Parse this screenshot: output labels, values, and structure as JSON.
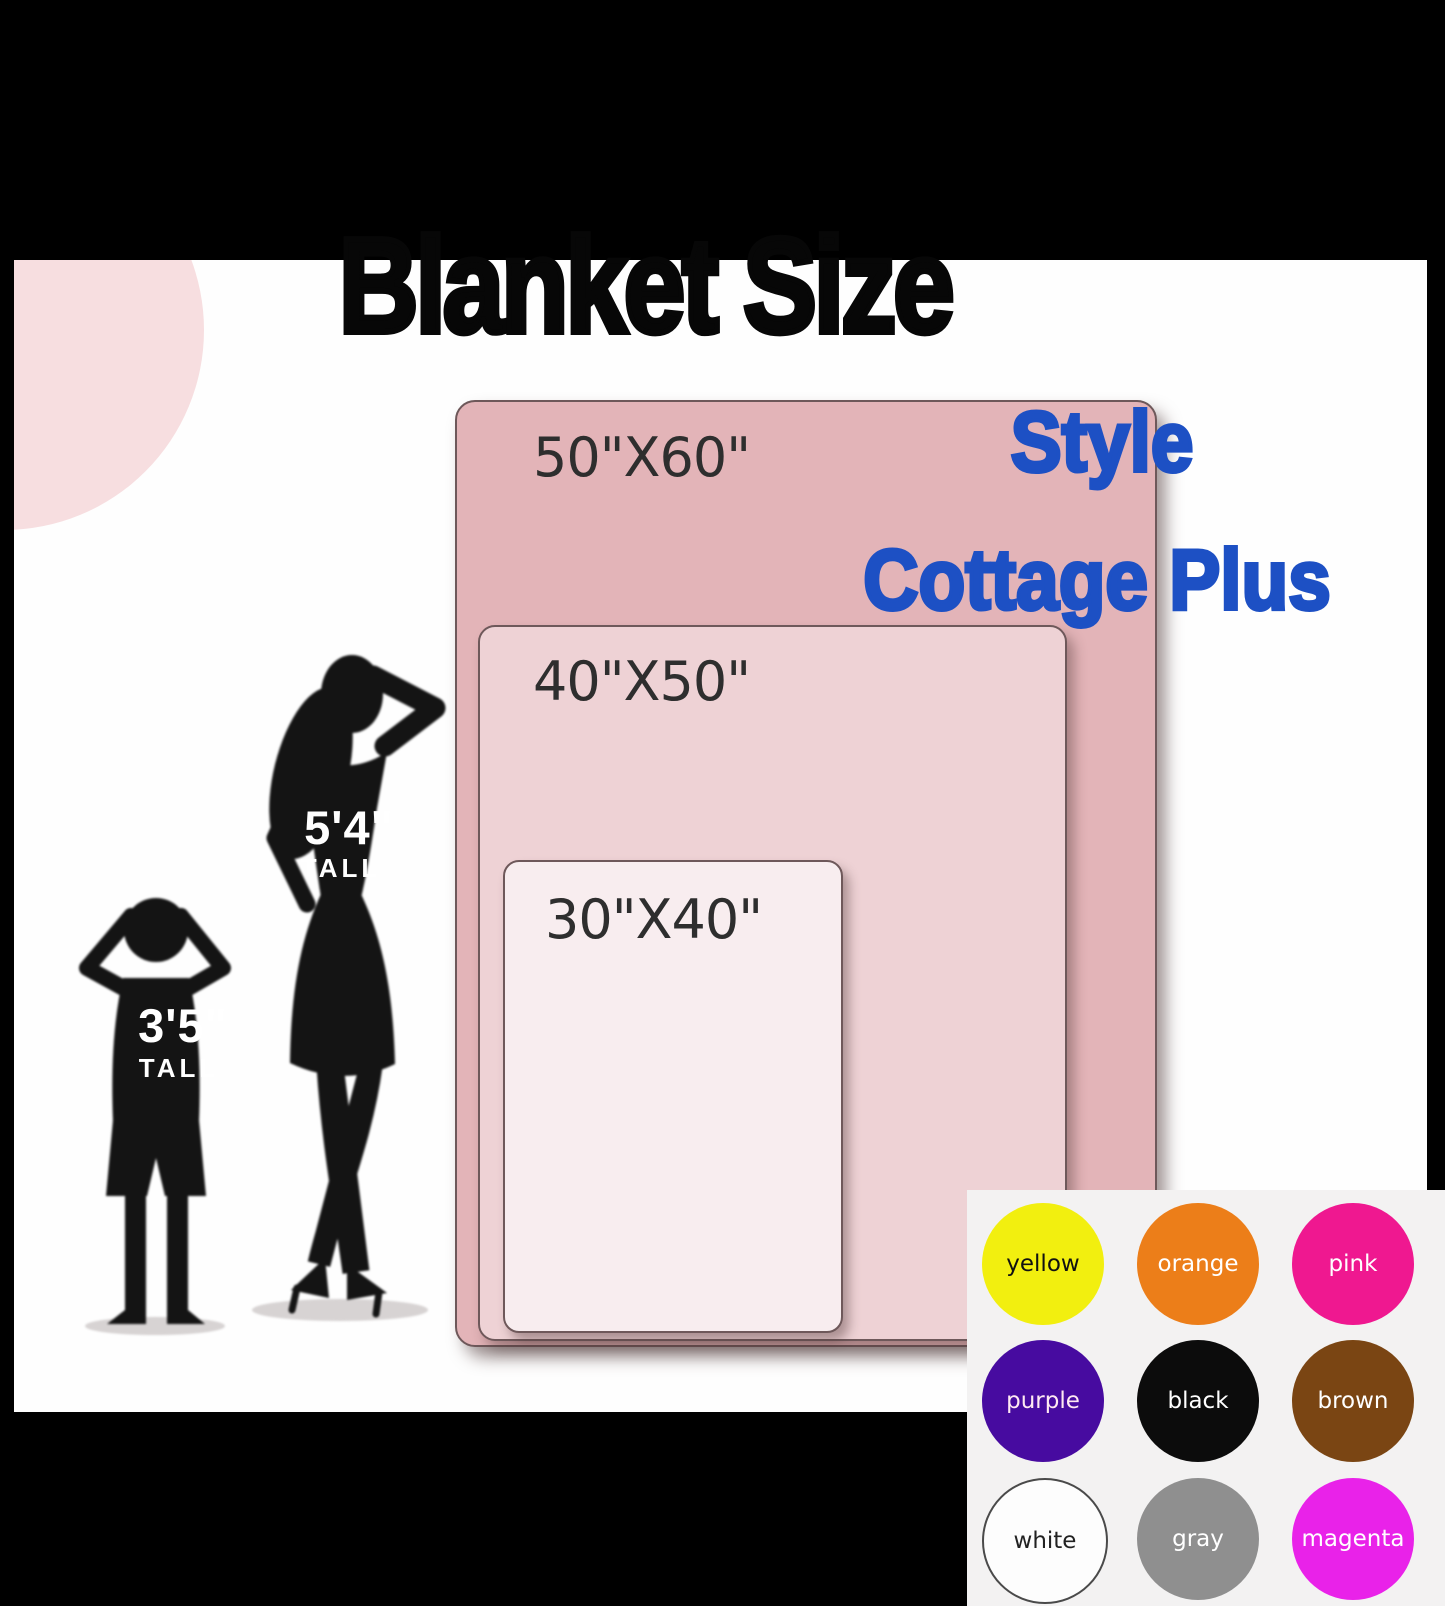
{
  "title": "Blanket Size",
  "style": {
    "label": "Style",
    "value": "Cottage Plus",
    "color": "#1d50c4"
  },
  "blankets": [
    {
      "size": "50\"X60\"",
      "color": "#e3b4b8"
    },
    {
      "size": "40\"X50\"",
      "color": "#eed2d5"
    },
    {
      "size": "30\"X40\"",
      "color": "#f8edef"
    }
  ],
  "figures": [
    {
      "height": "5'4\"",
      "label": "TALL"
    },
    {
      "height": "3'5\"",
      "label": "TALL"
    }
  ],
  "swatches": [
    {
      "name": "yellow",
      "hex": "#f2ef0f",
      "text": "#111111"
    },
    {
      "name": "orange",
      "hex": "#ec7e19",
      "text": "#ffffff"
    },
    {
      "name": "pink",
      "hex": "#ef1890",
      "text": "#ffffff"
    },
    {
      "name": "purple",
      "hex": "#470ba0",
      "text": "#ffe9f2"
    },
    {
      "name": "black",
      "hex": "#0c0c0c",
      "text": "#ffffff"
    },
    {
      "name": "brown",
      "hex": "#7a4513",
      "text": "#ffffff"
    },
    {
      "name": "white",
      "hex": "#fdfdfd",
      "text": "#222222",
      "outline": "#4a4a4a"
    },
    {
      "name": "gray",
      "hex": "#8f8f8f",
      "text": "#ffffff"
    },
    {
      "name": "magenta",
      "hex": "#e922e9",
      "text": "#ffffff"
    }
  ]
}
